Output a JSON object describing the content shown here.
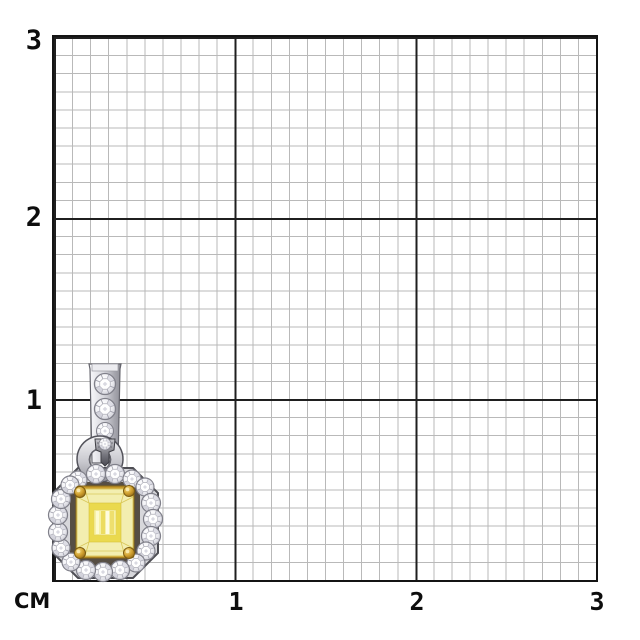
{
  "window": {
    "width": 640,
    "height": 640,
    "background": "#ffffff"
  },
  "ruler": {
    "unit_label": "СМ",
    "cm_count": 3,
    "minor_divisions_per_cm": 10,
    "x_axis": {
      "ticks": [
        "1",
        "2",
        "3"
      ]
    },
    "y_axis": {
      "ticks_top_to_bottom": [
        "3",
        "2",
        "1"
      ]
    }
  },
  "colors": {
    "grid_minor": "#b9b9b9",
    "grid_major": "#1f1f1f",
    "grid_border": "#141414",
    "tick_label": "#0d0d0d",
    "stone_yellow": "#ead94e",
    "stone_pale_yellow": "#f3eeb0",
    "gold_setting": "#c7992c",
    "metal_silver": "#d9d9de",
    "diamond_white": "#f4f4f7"
  }
}
